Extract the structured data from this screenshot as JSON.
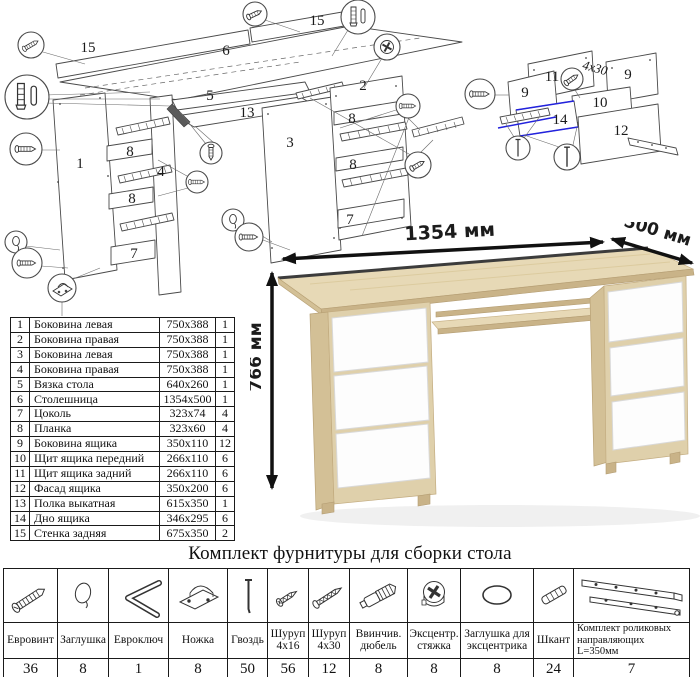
{
  "diagrams": {
    "main_labels": [
      "15",
      "6",
      "15",
      "5",
      "13",
      "1",
      "8",
      "4",
      "8",
      "7",
      "3",
      "2",
      "8",
      "8",
      "7"
    ],
    "drawer_labels": [
      "11",
      "9",
      "9",
      "10",
      "14",
      "12"
    ],
    "drawer_annotation": "4x30"
  },
  "desk": {
    "width_label": "1354 мм",
    "depth_label": "500 мм",
    "height_label": "766 мм"
  },
  "parts": {
    "rows": [
      {
        "num": "1",
        "name": "Боковина левая",
        "size": "750x388",
        "qty": "1"
      },
      {
        "num": "2",
        "name": "Боковина правая",
        "size": "750x388",
        "qty": "1"
      },
      {
        "num": "3",
        "name": "Боковина левая",
        "size": "750x388",
        "qty": "1"
      },
      {
        "num": "4",
        "name": "Боковина правая",
        "size": "750x388",
        "qty": "1"
      },
      {
        "num": "5",
        "name": "Вязка стола",
        "size": "640x260",
        "qty": "1"
      },
      {
        "num": "6",
        "name": "Столешница",
        "size": "1354x500",
        "qty": "1"
      },
      {
        "num": "7",
        "name": "Цоколь",
        "size": "323x74",
        "qty": "4"
      },
      {
        "num": "8",
        "name": "Планка",
        "size": "323x60",
        "qty": "4"
      },
      {
        "num": "9",
        "name": "Боковина ящика",
        "size": "350x110",
        "qty": "12"
      },
      {
        "num": "10",
        "name": "Щит ящика передний",
        "size": "266x110",
        "qty": "6"
      },
      {
        "num": "11",
        "name": "Щит ящика задний",
        "size": "266x110",
        "qty": "6"
      },
      {
        "num": "12",
        "name": "Фасад ящика",
        "size": "350x200",
        "qty": "6"
      },
      {
        "num": "13",
        "name": "Полка выкатная",
        "size": "615x350",
        "qty": "1"
      },
      {
        "num": "14",
        "name": "Дно ящика",
        "size": "346x295",
        "qty": "6"
      },
      {
        "num": "15",
        "name": "Стенка задняя",
        "size": "675x350",
        "qty": "2"
      }
    ]
  },
  "hardware": {
    "title": "Комплект фурнитуры для сборки стола",
    "items": [
      {
        "name": "Евровинт",
        "qty": "36",
        "icon": "confirmat-screw-icon"
      },
      {
        "name": "Заглушка",
        "qty": "8",
        "icon": "cap-icon"
      },
      {
        "name": "Евроключ",
        "qty": "1",
        "icon": "hex-key-icon"
      },
      {
        "name": "Ножка",
        "qty": "8",
        "icon": "foot-icon"
      },
      {
        "name": "Гвоздь",
        "qty": "50",
        "icon": "nail-icon"
      },
      {
        "name": "Шуруп 4x16",
        "qty": "56",
        "icon": "screw-4x16-icon"
      },
      {
        "name": "Шуруп 4x30",
        "qty": "12",
        "icon": "screw-4x30-icon"
      },
      {
        "name": "Ввинчив. дюбель",
        "qty": "8",
        "icon": "screw-in-dowel-icon"
      },
      {
        "name": "Эксцентр. стяжка",
        "qty": "8",
        "icon": "cam-lock-icon"
      },
      {
        "name": "Заглушка для эксцентрика",
        "qty": "8",
        "icon": "cam-cap-icon"
      },
      {
        "name": "Шкант",
        "qty": "24",
        "icon": "wood-dowel-icon"
      },
      {
        "name": "Комплект роликовых направляющих L=350мм",
        "qty": "7",
        "icon": "drawer-slides-icon"
      }
    ]
  }
}
